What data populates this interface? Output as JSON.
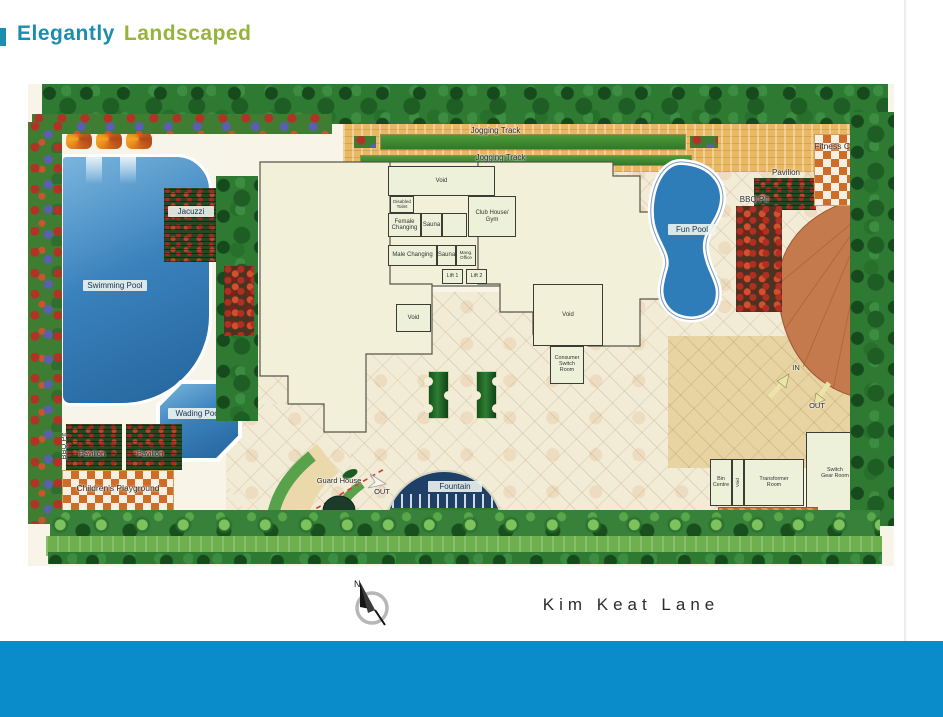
{
  "header": {
    "title_accent": "Elegantly",
    "title_secondary": "Landscaped"
  },
  "footer": {
    "street_name": "Kim Keat Lane",
    "compass_label": "N"
  },
  "plan": {
    "labels": {
      "jogging_track_top": "Jogging Track",
      "jogging_track_bottom": "Jogging Track",
      "swimming_pool": "Swimming Pool",
      "jacuzzi": "Jacuzzi",
      "wading_pool": "Wading Pool",
      "fun_pool": "Fun Pool",
      "fountain": "Fountain",
      "pavilion_west_1": "Pavilion",
      "pavilion_west_2": "Pavilion",
      "pavilion_east": "Pavilion",
      "bbq_pit_west": "BBQ Pit",
      "bbq_pit_east": "BBQ Pit",
      "fitness_corner": "Fitness Corner",
      "childrens_playground": "Children's Playground",
      "guard_house": "Guard House"
    },
    "rooms": {
      "void_top": "Void",
      "disabled_toilet": "Disabled Toilet",
      "female_changing": "Female Changing",
      "sauna_female": "Sauna",
      "club_house_gym": "Club House/ Gym",
      "male_changing": "Male Changing",
      "sauna_male": "Sauna",
      "mang_office": "Mang. Office",
      "lift_1": "Lift 1",
      "lift_2": "Lift 2",
      "void_block_a": "Void",
      "void_block_b": "Void",
      "consumer_switch_room": "Consumer Switch Room",
      "bin_centre": "Bin Centre",
      "void_bin": "Void",
      "transformer_room": "Transformer Room",
      "switch_gear_room": "Switch Gear Room"
    },
    "circulation": {
      "gate_out": "OUT",
      "gate_in": "IN",
      "drive_in": "IN",
      "drive_out": "OUT"
    }
  },
  "colors": {
    "title_accent": "#1b8dae",
    "title_secondary": "#96b43c",
    "bottom_bar": "#0a8cca",
    "pool_water": "#2e7cb8",
    "building_cream": "#f2f0d8",
    "stone_tan": "#e7d4a2",
    "terracotta_drive": "#c57a4e",
    "tree_green": "#1e5e24",
    "checker_orange": "#cf6d28"
  }
}
